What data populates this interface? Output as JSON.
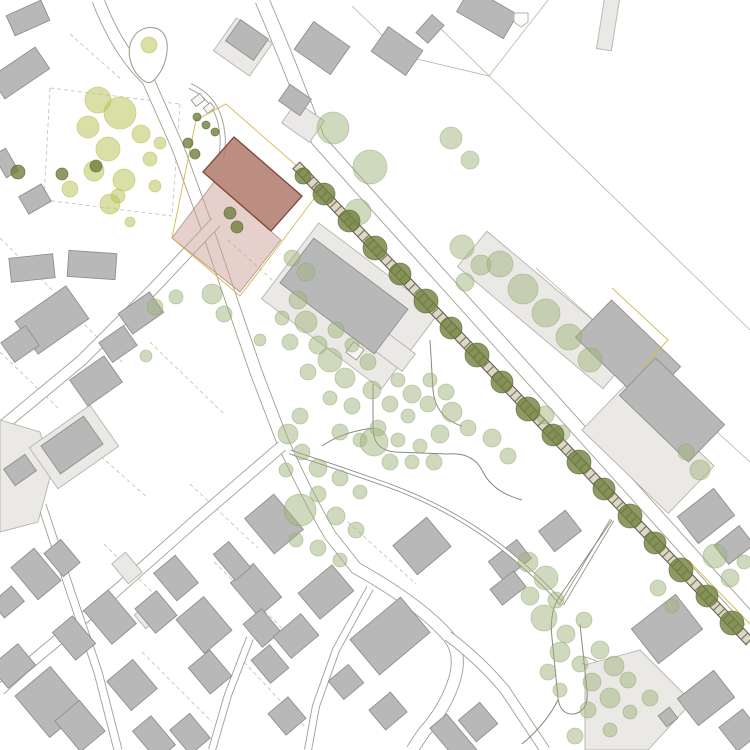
{
  "canvas": {
    "w": 750,
    "h": 750,
    "bg": "#ffffff"
  },
  "palette": {
    "road_casing": "#a29e93",
    "road_fill": "#ffffff",
    "boundary": "#b7b3a6",
    "parcel_dash": "#c9c5b7",
    "park_path": "#8a877d",
    "building_fill": "#b8b8b8",
    "building_stroke": "#8f8f8c",
    "annex_fill": "#eae9e5",
    "annex_stroke": "#b6b3ab",
    "shed_fill": "#f7f6f2",
    "rail_band": "#ded7c2",
    "rail_dark": "#5f5c54",
    "sage": "#9fb37c",
    "sage_stroke": "#8ba26a",
    "yellow_green": "#bcc45e",
    "olive": "#6d7d3a",
    "olive_stroke": "#565f2a",
    "project_fill": "#b0796b",
    "project_stroke": "#7c4637",
    "site_pink": "#cba297",
    "site_pink_stroke": "#b58d80",
    "boundary_yellow": "#ccb94e"
  },
  "boundary_lines": [
    "M440,28 L750,330",
    "M548,0 L489,76 L404,56",
    "M404,56 L352,6",
    "M536,268 L750,462"
  ],
  "dashed_lines": [
    "M50,88 L180,104",
    "M44,200 L172,216",
    "M50,88 L44,200",
    "M180,104 L172,216",
    "M228,240 L292,298",
    "M150,342 L224,414",
    "M64,424 L148,498",
    "M190,484 L258,548",
    "M104,544 L172,612",
    "M214,562 L282,628",
    "M142,652 L212,722",
    "M244,662 L306,728",
    "M60,300 L124,364",
    "M0,352 L60,410",
    "M70,34 L122,80",
    "M0,238 L56,294",
    "M348,522 L416,584"
  ],
  "roads": [
    {
      "d": "M98,0 Q118,52 148,80 L178,148 L205,222 L232,302 L256,372 L282,440 Q305,492 330,535 L356,568 Q420,604 448,636 Q462,652 455,678 Q446,708 424,732 L412,750",
      "w": 13
    },
    {
      "d": "M448,636 Q480,660 505,690 L545,750",
      "w": 11
    },
    {
      "d": "M262,0 Q292,70 318,140 L750,620",
      "w": 15
    },
    {
      "d": "M216,222 L154,288 L82,360 L0,428",
      "w": 12
    },
    {
      "d": "M282,446 L196,520 L108,598 L24,668 L0,690",
      "w": 12
    },
    {
      "d": "M370,588 L336,650 L316,706 L308,750",
      "w": 8
    },
    {
      "d": "M42,505 L70,590 L98,672 L118,750",
      "w": 9
    },
    {
      "d": "M250,638 L228,695 L212,750",
      "w": 8
    },
    {
      "d": "M190,86 Q214,97 220,121 Q225,140 221,158",
      "w": 6
    },
    {
      "d": "M583,660 Q620,670 628,710 Q633,740 618,750",
      "w": 8
    }
  ],
  "teardrop": "M146,82 C130,73 125,50 133,38 C140,26 156,24 163,33 C171,43 167,65 156,78 C153,81 150,84 146,82 Z",
  "buildings_light": [
    [
      243,
      47,
      44,
      40,
      35
    ],
    [
      303,
      122,
      34,
      26,
      35
    ],
    [
      74,
      447,
      74,
      50,
      -35
    ],
    [
      350,
      306,
      150,
      95,
      37
    ],
    [
      392,
      350,
      42,
      22,
      37
    ],
    [
      545,
      310,
      190,
      46,
      40
    ],
    [
      648,
      448,
      120,
      66,
      44
    ],
    [
      608,
      24,
      15,
      52,
      9
    ],
    [
      127,
      568,
      26,
      18,
      50
    ],
    [
      147,
      616,
      18,
      18,
      50
    ]
  ],
  "light_polys": [
    "0,420 40,432 52,470 38,522 0,532",
    "585,665 640,650 692,702 648,750 585,750"
  ],
  "buildings_gray": [
    [
      28,
      18,
      38,
      22,
      -24
    ],
    [
      20,
      73,
      54,
      26,
      -34
    ],
    [
      6,
      163,
      14,
      26,
      -30
    ],
    [
      35,
      199,
      26,
      20,
      -30
    ],
    [
      32,
      268,
      44,
      24,
      -6
    ],
    [
      92,
      265,
      48,
      26,
      4
    ],
    [
      141,
      313,
      38,
      25,
      -35
    ],
    [
      52,
      320,
      62,
      40,
      -35
    ],
    [
      20,
      344,
      30,
      24,
      -35
    ],
    [
      118,
      344,
      30,
      24,
      -35
    ],
    [
      96,
      381,
      42,
      32,
      -35
    ],
    [
      72,
      445,
      52,
      34,
      -35
    ],
    [
      20,
      470,
      26,
      20,
      -35
    ],
    [
      247,
      40,
      34,
      26,
      35
    ],
    [
      322,
      48,
      44,
      34,
      35
    ],
    [
      295,
      100,
      26,
      20,
      35
    ],
    [
      397,
      51,
      42,
      30,
      35
    ],
    [
      430,
      29,
      16,
      24,
      42
    ],
    [
      487,
      13,
      54,
      28,
      30
    ],
    [
      344,
      296,
      118,
      56,
      37
    ],
    [
      628,
      352,
      96,
      52,
      44
    ],
    [
      672,
      410,
      96,
      52,
      44
    ],
    [
      36,
      574,
      42,
      30,
      50
    ],
    [
      62,
      558,
      30,
      22,
      50
    ],
    [
      8,
      602,
      20,
      26,
      50
    ],
    [
      110,
      617,
      44,
      32,
      50
    ],
    [
      74,
      638,
      36,
      26,
      50
    ],
    [
      13,
      666,
      28,
      36,
      50
    ],
    [
      50,
      702,
      46,
      54,
      -40
    ],
    [
      80,
      726,
      32,
      40,
      -40
    ],
    [
      132,
      685,
      38,
      34,
      50
    ],
    [
      176,
      578,
      36,
      28,
      50
    ],
    [
      156,
      612,
      32,
      28,
      50
    ],
    [
      204,
      625,
      44,
      36,
      50
    ],
    [
      210,
      672,
      34,
      28,
      50
    ],
    [
      256,
      590,
      44,
      30,
      50
    ],
    [
      232,
      561,
      34,
      20,
      50
    ],
    [
      262,
      628,
      30,
      24,
      50
    ],
    [
      270,
      664,
      30,
      24,
      50
    ],
    [
      154,
      738,
      38,
      24,
      50
    ],
    [
      190,
      734,
      32,
      26,
      50
    ],
    [
      274,
      524,
      46,
      38,
      50
    ],
    [
      326,
      592,
      44,
      34,
      -40
    ],
    [
      296,
      636,
      36,
      28,
      -40
    ],
    [
      422,
      546,
      44,
      38,
      -40
    ],
    [
      390,
      636,
      66,
      46,
      -40
    ],
    [
      346,
      682,
      26,
      24,
      -40
    ],
    [
      287,
      716,
      28,
      26,
      50
    ],
    [
      388,
      711,
      26,
      28,
      50
    ],
    [
      455,
      741,
      52,
      22,
      50
    ],
    [
      478,
      722,
      28,
      28,
      -40
    ],
    [
      510,
      560,
      36,
      24,
      -38
    ],
    [
      508,
      588,
      30,
      20,
      -38
    ],
    [
      560,
      531,
      34,
      26,
      -38
    ],
    [
      706,
      516,
      46,
      34,
      -38
    ],
    [
      734,
      545,
      32,
      24,
      -38
    ],
    [
      667,
      629,
      56,
      44,
      -38
    ],
    [
      706,
      698,
      46,
      34,
      -38
    ],
    [
      740,
      730,
      30,
      30,
      -38
    ],
    [
      668,
      717,
      14,
      14,
      -38
    ]
  ],
  "structures_white": [
    [
      198,
      100,
      11,
      8,
      -38
    ],
    [
      209,
      108,
      9,
      7,
      -38
    ],
    [
      355,
      351,
      13,
      13,
      37
    ]
  ],
  "pentagon": "514,13 528,13 528,22 521,27 514,22",
  "site": {
    "pink": "214,182 281,240 240,292 172,238",
    "red": "234,137 302,196 271,231 203,172",
    "yellow_paths": [
      "M226,104 L322,188 L280,244 L240,296 L172,238 L196,120 Z",
      "M612,288 L668,340 L642,368",
      "M688,560 L750,624"
    ]
  },
  "railway": {
    "d": "M296,165 L750,642"
  },
  "park_paths": [
    {
      "d": "M290,452 Q340,468 390,486 Q450,508 500,546 Q540,578 562,604",
      "dbl": true
    },
    {
      "d": "M562,604 Q588,560 612,520",
      "dbl": true
    },
    {
      "d": "M373,384 L373,428 Q373,450 395,452 L448,454",
      "dbl": false
    },
    {
      "d": "M448,454 Q472,452 482,470 Q492,492 522,500",
      "dbl": false
    },
    {
      "d": "M430,340 L433,390 Q436,418 462,426",
      "dbl": false
    },
    {
      "d": "M612,520 L560,596 Q549,611 552,638 L558,698 Q560,715 574,714 Q589,711 587,690 L580,624",
      "dbl": false
    },
    {
      "d": "M558,700 Q546,724 522,744",
      "dbl": false
    },
    {
      "d": "M373,428 Q342,432 322,446",
      "dbl": false
    }
  ],
  "trees": {
    "sage": [
      [
        333,
        128,
        16
      ],
      [
        370,
        167,
        17
      ],
      [
        358,
        212,
        13
      ],
      [
        451,
        138,
        11
      ],
      [
        470,
        160,
        9
      ],
      [
        462,
        247,
        12
      ],
      [
        481,
        265,
        10
      ],
      [
        465,
        282,
        9
      ],
      [
        292,
        258,
        8
      ],
      [
        306,
        272,
        9
      ],
      [
        298,
        300,
        9
      ],
      [
        282,
        318,
        7
      ],
      [
        306,
        322,
        11
      ],
      [
        290,
        342,
        8
      ],
      [
        318,
        345,
        9
      ],
      [
        336,
        330,
        8
      ],
      [
        330,
        360,
        12
      ],
      [
        352,
        345,
        7
      ],
      [
        308,
        372,
        8
      ],
      [
        345,
        378,
        10
      ],
      [
        368,
        362,
        8
      ],
      [
        372,
        390,
        9
      ],
      [
        352,
        406,
        8
      ],
      [
        330,
        398,
        7
      ],
      [
        390,
        404,
        8
      ],
      [
        398,
        380,
        7
      ],
      [
        412,
        394,
        9
      ],
      [
        408,
        416,
        7
      ],
      [
        428,
        404,
        8
      ],
      [
        430,
        380,
        7
      ],
      [
        446,
        392,
        8
      ],
      [
        452,
        412,
        10
      ],
      [
        468,
        428,
        8
      ],
      [
        440,
        434,
        9
      ],
      [
        420,
        446,
        7
      ],
      [
        398,
        440,
        7
      ],
      [
        378,
        428,
        8
      ],
      [
        360,
        440,
        7
      ],
      [
        340,
        432,
        8
      ],
      [
        374,
        442,
        14
      ],
      [
        390,
        462,
        8
      ],
      [
        412,
        462,
        7
      ],
      [
        434,
        462,
        8
      ],
      [
        300,
        416,
        8
      ],
      [
        288,
        434,
        10
      ],
      [
        302,
        452,
        8
      ],
      [
        286,
        470,
        7
      ],
      [
        318,
        468,
        9
      ],
      [
        340,
        478,
        8
      ],
      [
        360,
        492,
        7
      ],
      [
        318,
        494,
        8
      ],
      [
        300,
        510,
        16
      ],
      [
        336,
        516,
        9
      ],
      [
        356,
        530,
        8
      ],
      [
        296,
        540,
        7
      ],
      [
        318,
        548,
        8
      ],
      [
        340,
        560,
        7
      ],
      [
        492,
        438,
        9
      ],
      [
        508,
        456,
        8
      ],
      [
        500,
        264,
        13
      ],
      [
        523,
        289,
        15
      ],
      [
        546,
        313,
        14
      ],
      [
        569,
        337,
        13
      ],
      [
        590,
        360,
        12
      ],
      [
        545,
        415,
        9
      ],
      [
        562,
        433,
        8
      ],
      [
        700,
        470,
        10
      ],
      [
        686,
        452,
        8
      ],
      [
        528,
        562,
        10
      ],
      [
        546,
        578,
        12
      ],
      [
        530,
        596,
        9
      ],
      [
        556,
        600,
        8
      ],
      [
        544,
        618,
        13
      ],
      [
        566,
        634,
        9
      ],
      [
        584,
        620,
        8
      ],
      [
        560,
        652,
        10
      ],
      [
        580,
        664,
        8
      ],
      [
        600,
        650,
        9
      ],
      [
        614,
        666,
        10
      ],
      [
        592,
        682,
        9
      ],
      [
        628,
        680,
        8
      ],
      [
        610,
        698,
        10
      ],
      [
        588,
        710,
        8
      ],
      [
        630,
        712,
        7
      ],
      [
        650,
        698,
        8
      ],
      [
        560,
        690,
        7
      ],
      [
        548,
        672,
        8
      ],
      [
        575,
        736,
        8
      ],
      [
        610,
        730,
        7
      ],
      [
        658,
        588,
        8
      ],
      [
        672,
        606,
        7
      ],
      [
        715,
        556,
        12
      ],
      [
        730,
        578,
        9
      ],
      [
        744,
        562,
        7
      ],
      [
        155,
        307,
        8
      ],
      [
        176,
        297,
        7
      ],
      [
        212,
        294,
        10
      ],
      [
        224,
        314,
        8
      ],
      [
        146,
        356,
        6
      ],
      [
        260,
        340,
        6
      ]
    ],
    "yellow_green": [
      [
        98,
        100,
        13
      ],
      [
        120,
        113,
        16
      ],
      [
        88,
        127,
        11
      ],
      [
        141,
        134,
        9
      ],
      [
        108,
        149,
        12
      ],
      [
        150,
        159,
        7
      ],
      [
        94,
        171,
        10
      ],
      [
        124,
        180,
        11
      ],
      [
        70,
        189,
        8
      ],
      [
        110,
        204,
        10
      ],
      [
        160,
        143,
        6
      ],
      [
        155,
        186,
        6
      ],
      [
        130,
        222,
        5
      ],
      [
        118,
        196,
        7
      ],
      [
        149,
        45,
        8
      ]
    ],
    "olive": [
      [
        303,
        176,
        8
      ],
      [
        324,
        194,
        11
      ],
      [
        349,
        221,
        11
      ],
      [
        375,
        248,
        12
      ],
      [
        400,
        274,
        11
      ],
      [
        426,
        301,
        12
      ],
      [
        451,
        328,
        11
      ],
      [
        477,
        355,
        12
      ],
      [
        502,
        382,
        11
      ],
      [
        528,
        409,
        12
      ],
      [
        553,
        435,
        11
      ],
      [
        579,
        462,
        12
      ],
      [
        604,
        489,
        11
      ],
      [
        630,
        516,
        12
      ],
      [
        655,
        543,
        11
      ],
      [
        681,
        570,
        12
      ],
      [
        707,
        596,
        11
      ],
      [
        732,
        623,
        12
      ],
      [
        18,
        172,
        7
      ],
      [
        62,
        174,
        6
      ],
      [
        96,
        166,
        6
      ],
      [
        188,
        143,
        5
      ],
      [
        195,
        154,
        5
      ],
      [
        197,
        117,
        4
      ],
      [
        206,
        125,
        4
      ],
      [
        215,
        132,
        4
      ],
      [
        230,
        213,
        6
      ],
      [
        237,
        227,
        6
      ]
    ]
  }
}
